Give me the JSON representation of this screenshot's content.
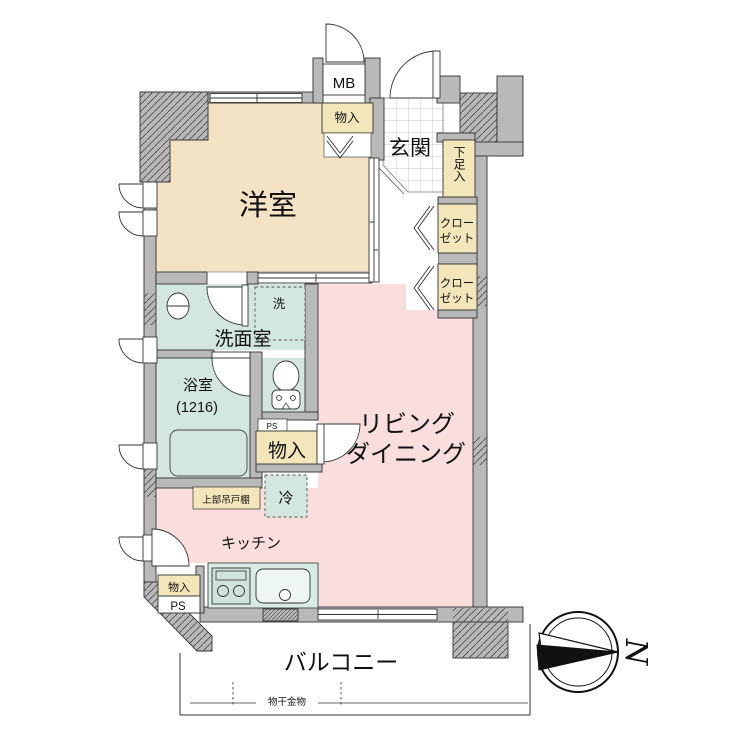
{
  "plan": {
    "title": "apartment-floor-plan",
    "rooms": {
      "western_room": {
        "label": "洋室",
        "color": "#f4e2c4"
      },
      "entrance": {
        "label": "玄関",
        "floor": "tile"
      },
      "washroom": {
        "label": "洗面室",
        "color": "#d3e7e0"
      },
      "bathroom": {
        "label": "浴室",
        "size": "(1216)",
        "color": "#d3e7e0"
      },
      "living_dining": {
        "label_line1": "リビング",
        "label_line2": "ダイニング",
        "color": "#fadddd"
      },
      "kitchen": {
        "label": "キッチン",
        "color": "#fadddd"
      },
      "balcony": {
        "label": "バルコニー"
      }
    },
    "storage": {
      "meter_box": "MB",
      "bedroom_storage": "物入",
      "shoe_cabinet": "下足入",
      "closet1_line1": "クロー",
      "closet1_line2": "ゼット",
      "closet2_line1": "クロー",
      "closet2_line2": "ゼット",
      "hall_storage": "物入",
      "kitchen_storage": "物入",
      "upper_cabinet": "上部吊戸棚"
    },
    "fixtures": {
      "washer_space": "洗",
      "fridge_space": "冷",
      "pipe_space_upper": "PS",
      "pipe_space_lower": "PS",
      "laundry_hardware": "物干金物",
      "equipment": [
        "bathtub",
        "toilet",
        "washbasin",
        "stove",
        "sink"
      ]
    },
    "compass": {
      "north_label": "N",
      "direction": "right"
    },
    "colors": {
      "wall": "#b9b9b9",
      "bedroom": "#f4e2c4",
      "wet_area": "#d3e7e0",
      "living": "#fadddd",
      "storage_box": "#f3e6bb",
      "counter": "#d9ebe5",
      "outline": "#333333"
    }
  }
}
